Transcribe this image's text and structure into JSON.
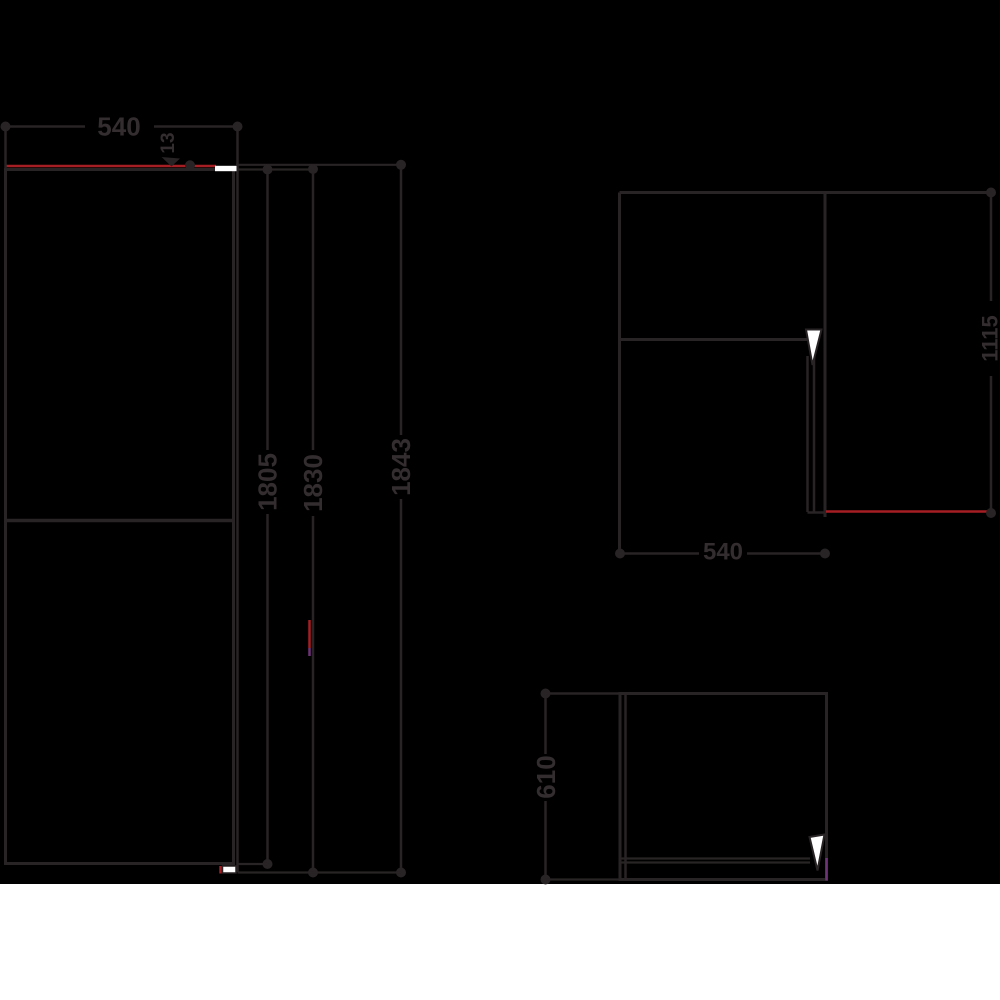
{
  "colors": {
    "background": "#000000",
    "bottom_band": "#ffffff",
    "line": "#282324",
    "text": "#332d2f",
    "accent_red": "#a51e23",
    "accent_purple": "#6e3376",
    "white_detail": "#ffffff"
  },
  "front_view": {
    "width": "540",
    "hinge_offset": "13",
    "height_cabinet": "1805",
    "height_mid": "1830",
    "height_total": "1843"
  },
  "top_view_open": {
    "depth_door_open": "1115",
    "width": "540"
  },
  "top_view_closed": {
    "depth": "610"
  }
}
